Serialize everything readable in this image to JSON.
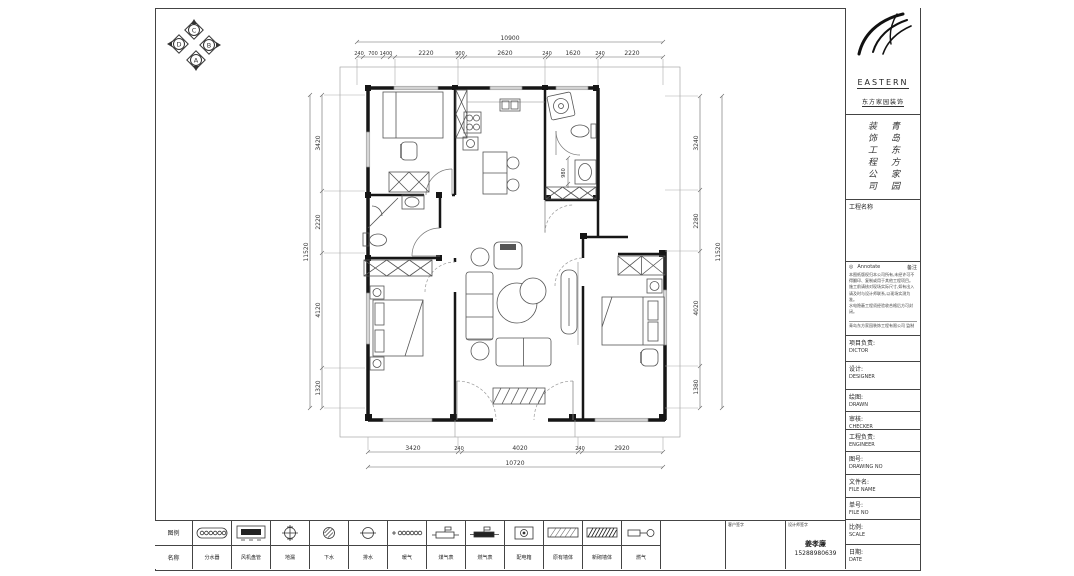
{
  "compass": {
    "top": "C",
    "right": "B",
    "bottom": "A",
    "left": "D"
  },
  "dims": {
    "top_overall": "10900",
    "top_segments": [
      "240",
      "700",
      "1400",
      "2220",
      "900",
      "2620",
      "240",
      "1620",
      "240",
      "2220"
    ],
    "bottom_overall": "10720",
    "bottom_segments": [
      "3420",
      "240",
      "4020",
      "240",
      "2920"
    ],
    "left_overall": "11520",
    "left_segments": [
      "3420",
      "2220",
      "4120",
      "1320"
    ],
    "right_overall": "11520",
    "right_segments": [
      "3240",
      "2280",
      "4020",
      "1380"
    ],
    "interior": [
      "980"
    ]
  },
  "title_block": {
    "brand": "EASTERN",
    "brand_cn": "东方家园装饰",
    "company_col_right": "青岛东方家园",
    "company_col_left": "装饰工程公司",
    "project_label": "工程名称",
    "notes": {
      "header_icon": "◎",
      "header_left": "Annotate",
      "header_right": "备注",
      "lines": [
        "本图纸版权归本公司所有,未经许可不",
        "得翻印、复制或用于其他工程项目。",
        "施工前请核对现场实际尺寸,如有出入",
        "请及时与设计师联系,以现场实测为准。",
        "水电隐蔽工程须经验收合格后方可封闭。"
      ],
      "footer": "青岛东方家园装饰工程有限公司 监制"
    },
    "fields": [
      {
        "cn": "项目负责:",
        "en": "DICTOR"
      },
      {
        "cn": "设计:",
        "en": "DESIGNER"
      },
      {
        "cn": "绘图:",
        "en": "DRAWN"
      },
      {
        "cn": "审核:",
        "en": "CHECKER"
      },
      {
        "cn": "工程负责:",
        "en": "ENGINEER"
      },
      {
        "cn": "图号:",
        "en": "DRAWING NO"
      },
      {
        "cn": "文件名:",
        "en": "FILE NAME"
      },
      {
        "cn": "单号:",
        "en": "FILE NO"
      },
      {
        "cn": "比例:",
        "en": "SCALE"
      },
      {
        "cn": "日期:",
        "en": "DATE"
      }
    ]
  },
  "legend": {
    "header_top": "图例",
    "header_bottom": "名称",
    "items": [
      {
        "name": "分水器"
      },
      {
        "name": "风机盘管"
      },
      {
        "name": "地漏"
      },
      {
        "name": "下水"
      },
      {
        "name": "排水"
      },
      {
        "name": "暖气"
      },
      {
        "name": "煤气表"
      },
      {
        "name": "燃气表"
      },
      {
        "name": "配电箱"
      },
      {
        "name": "原有墙体"
      },
      {
        "name": "新砌墙体"
      },
      {
        "name": "燃气"
      }
    ]
  },
  "signature": {
    "cell1_label": "客户签字",
    "cell2_label": "设计师签字",
    "name": "姜孝廉",
    "phone": "15288980639"
  }
}
